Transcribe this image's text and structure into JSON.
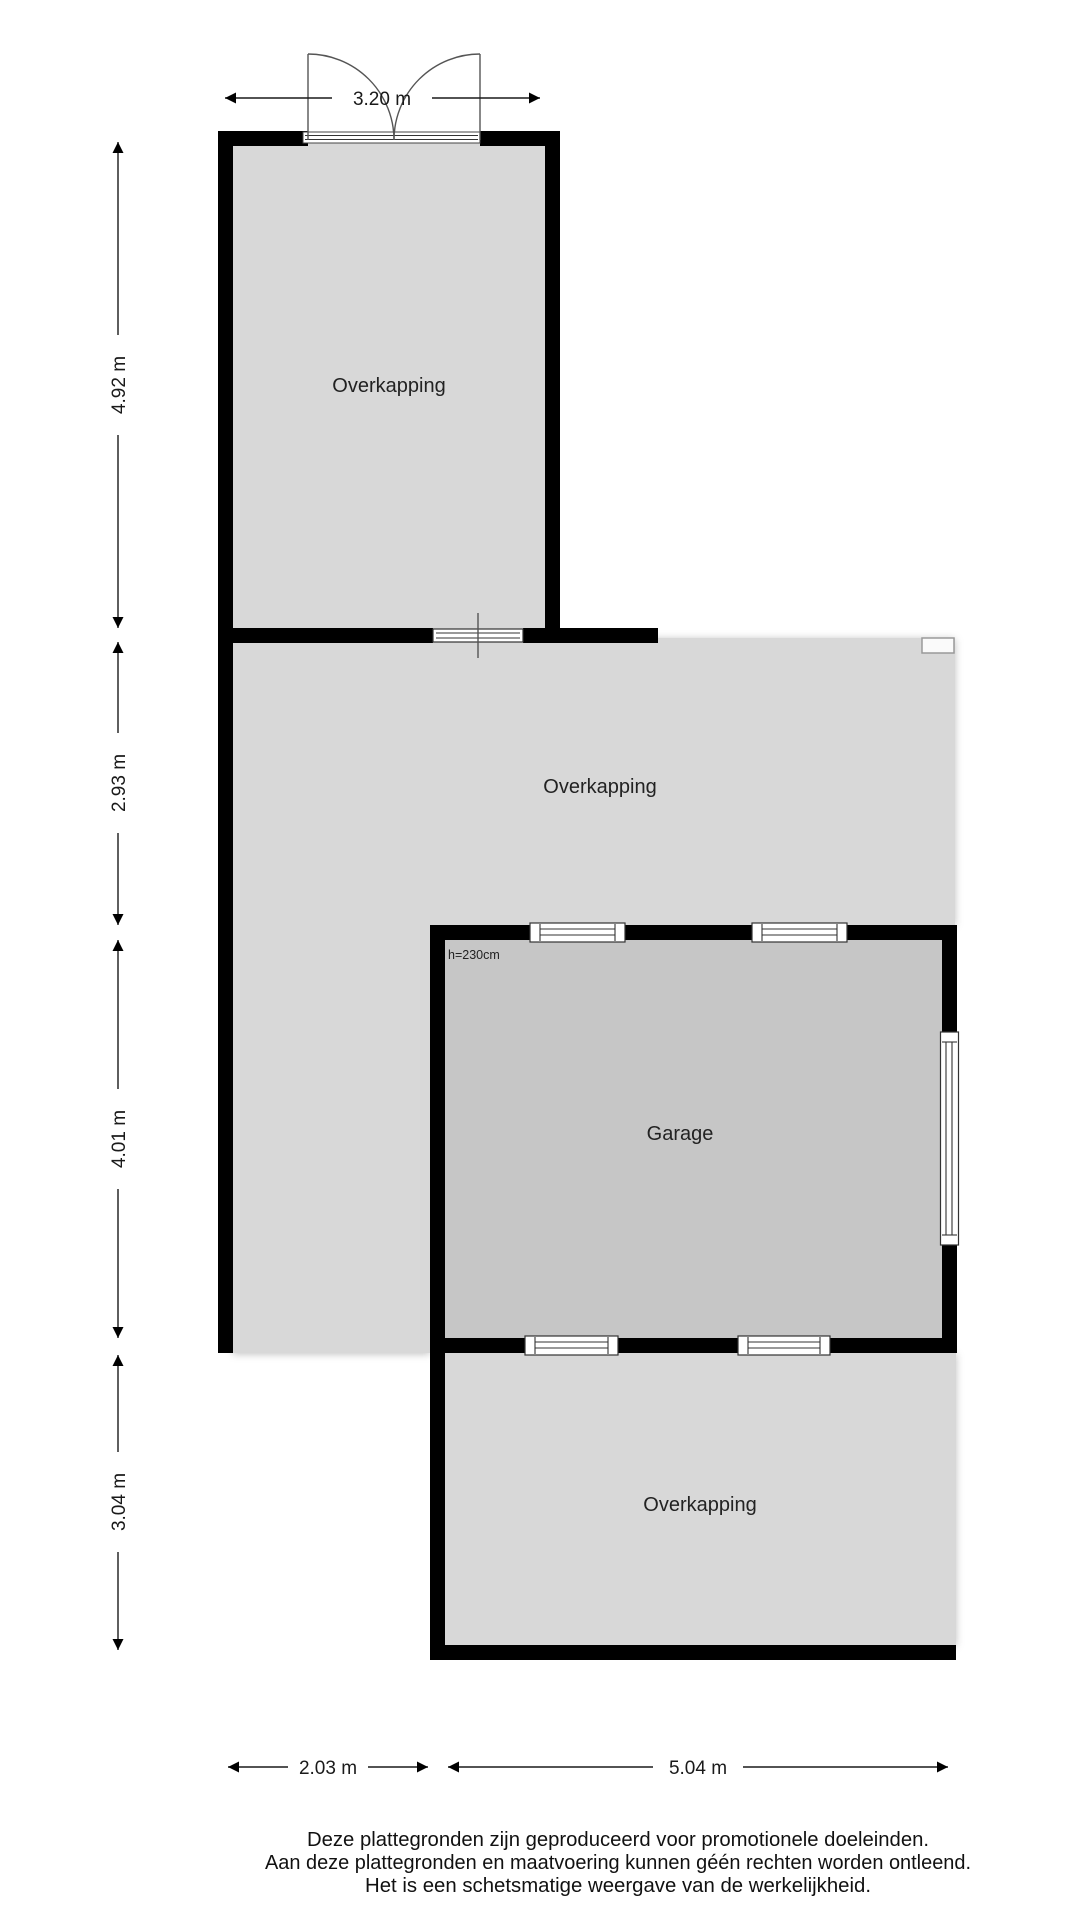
{
  "plan": {
    "rooms": {
      "top": {
        "label": "Overkapping"
      },
      "middle": {
        "label": "Overkapping"
      },
      "garage": {
        "label": "Garage",
        "height_note": "h=230cm"
      },
      "bottom": {
        "label": "Overkapping"
      }
    },
    "dimensions": {
      "top_width": "3.20 m",
      "left_top": "4.92 m",
      "left_middle": "2.93 m",
      "left_garage": "4.01 m",
      "left_bottom": "3.04 m",
      "bottom_left": "2.03 m",
      "bottom_right": "5.04 m"
    },
    "colors": {
      "wall": "#000000",
      "floor_light": "#d8d8d8",
      "floor_garage": "#c6c6c6",
      "background": "#ffffff",
      "dimension": "#1a1a1a"
    }
  },
  "footer": {
    "line1": "Deze plattegronden zijn geproduceerd voor promotionele doeleinden.",
    "line2": "Aan deze plattegronden en maatvoering kunnen géén rechten worden ontleend.",
    "line3": "Het is een schetsmatige weergave van de werkelijkheid."
  }
}
